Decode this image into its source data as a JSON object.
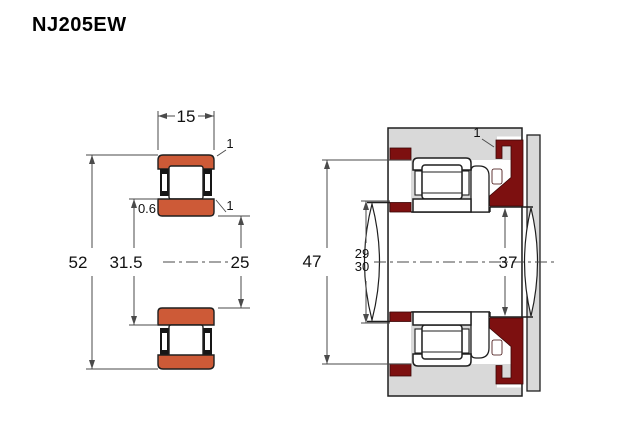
{
  "title": "NJ205EW",
  "colors": {
    "ring_orange": "#CD5A37",
    "abutment_red": "#7D1010",
    "housing_gray": "#D9D9D9",
    "outline": "#1f1f1f",
    "dim_line": "#4a4a4a"
  },
  "side_view": {
    "label": "bearing cross-section",
    "dims": {
      "width": "15",
      "outer_diameter": "52",
      "rib_diameter": "31.5",
      "bore_diameter": "25",
      "chamfer_outer": "1",
      "chamfer_inner": "1",
      "chamfer_rib": "0.6"
    }
  },
  "mounted_view": {
    "label": "mounting arrangement",
    "dims": {
      "housing_abutment_diameter": "47",
      "shaft_abutment_diameter_min": "29",
      "shaft_abutment_diameter_max": "30",
      "right_abutment_diameter": "37",
      "fillet": "1"
    }
  }
}
